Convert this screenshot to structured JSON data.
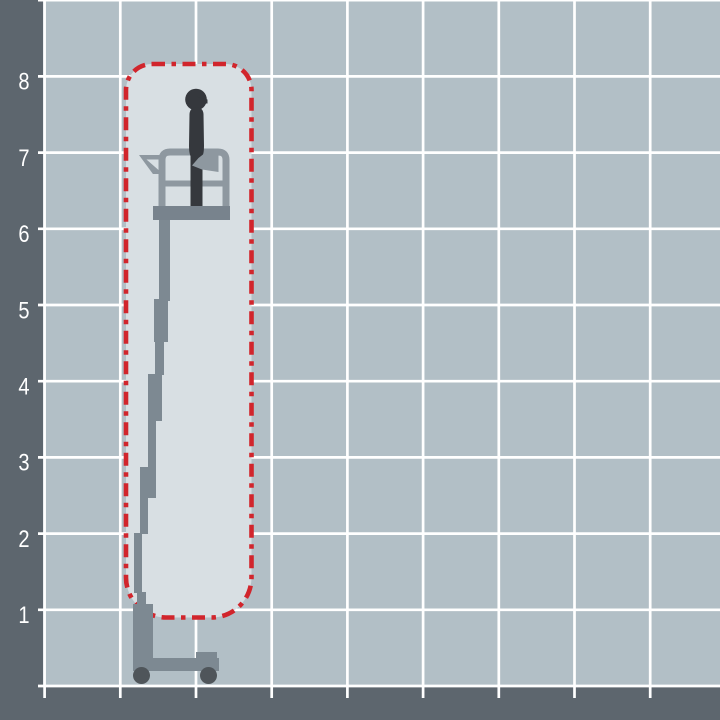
{
  "diagram": {
    "type": "working-envelope-diagram",
    "machine": "vertical-mast-lift-with-operator",
    "axis": {
      "y_ticks": [
        "8",
        "7",
        "6",
        "5",
        "4",
        "3",
        "2",
        "1"
      ]
    },
    "envelope": {
      "top_grid_units": 8.2,
      "bottom_grid_units": 0.9,
      "width_grid_units": 1.65
    }
  },
  "colors": {
    "background": "#b2bfc6",
    "grid_line": "#ffffff",
    "axis_bar": "#5d666e",
    "axis_label": "#ffffff",
    "envelope_fill": "#d8dfe3",
    "envelope_border": "#d1252c",
    "machine_gray": "#7d8992",
    "rail_gray": "#8e98a0",
    "floor_gray": "#78838d",
    "wheel_gray": "#4f555a",
    "operator_silhouette": "#35383d"
  }
}
